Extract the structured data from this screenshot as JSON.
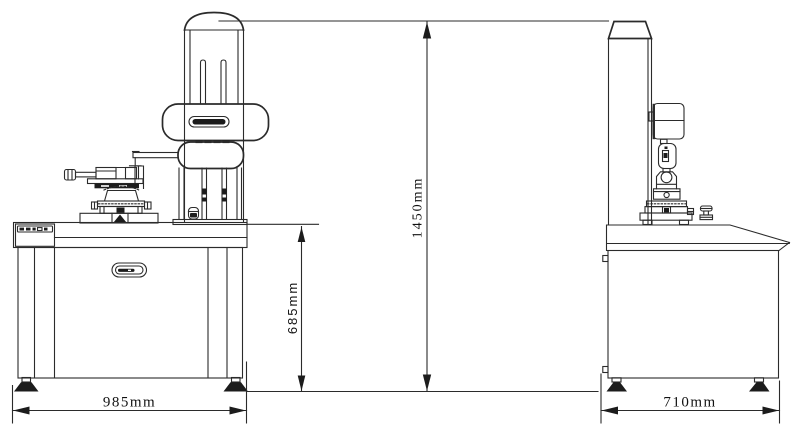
{
  "drawing": {
    "type": "technical-dimension-drawing",
    "dims": {
      "front_width": "985mm",
      "worktable_height": "685mm",
      "overall_height": "1450mm",
      "side_depth": "710mm"
    },
    "colors": {
      "line": "#2b2b2b",
      "solid_fill": "#1c1c1c",
      "background": "#ffffff"
    }
  }
}
